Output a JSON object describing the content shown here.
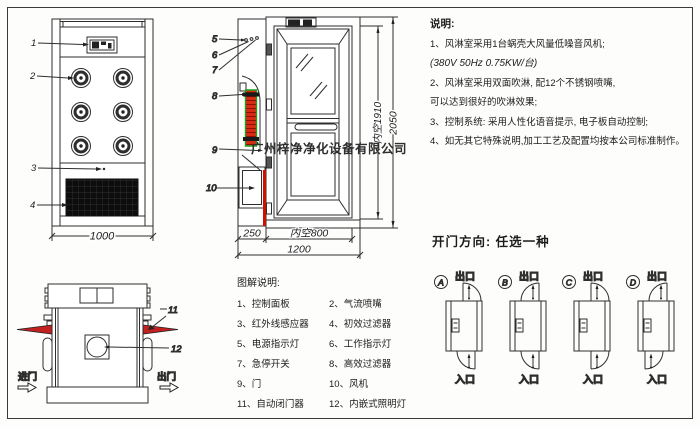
{
  "watermark": "广州梓净净化设备有限公司",
  "notes": {
    "title": "说明:",
    "lines": [
      "1、风淋室采用1台蜗壳大风量低噪音风机;",
      "(380V  50Hz  0.75KW/台)",
      "2、风淋室采用双面吹淋, 配12个不锈钢喷嘴,",
      "可以达到很好的吹淋效果;",
      "3、控制系统: 采用人性化语音提示, 电子板自动控制;",
      "4、如无其它特殊说明,加工工艺及配置均按本公司标准制作。"
    ]
  },
  "front_view": {
    "dim_width": "1000",
    "callout_1": "1",
    "callout_2": "2",
    "callout_3": "3",
    "callout_4": "4"
  },
  "side_view": {
    "dim_inner_height": "内空1910",
    "dim_total_height": "2050",
    "dim_left_width": "250",
    "dim_inner_width": "内空800",
    "dim_total_width": "1200",
    "callout_5": "5",
    "callout_6": "6",
    "callout_7": "7",
    "callout_8": "8",
    "callout_9": "9",
    "callout_10": "10"
  },
  "top_view": {
    "enter_label": "进门",
    "exit_label": "出门",
    "callout_11": "11",
    "callout_12": "12"
  },
  "legend": {
    "title": "图解说明:",
    "left": [
      "1、控制面板",
      "3、红外线感应器",
      "5、电源指示灯",
      "7、急停开关",
      "9、门",
      "11、自动闭门器"
    ],
    "right": [
      "2、气流喷嘴",
      "4、初效过滤器",
      "6、工作指示灯",
      "8、高效过滤器",
      "10、风机",
      "12、内嵌式照明灯"
    ]
  },
  "door_options": {
    "heading": "开门方向: 任选一种",
    "exit_label": "出口",
    "entry_label": "入口",
    "labels": [
      "A",
      "B",
      "C",
      "D"
    ]
  },
  "colors": {
    "line": "#2e2e2e",
    "filter_red": "#d92b14",
    "filter_green": "#1aa31a",
    "wing_red": "#c32020"
  }
}
